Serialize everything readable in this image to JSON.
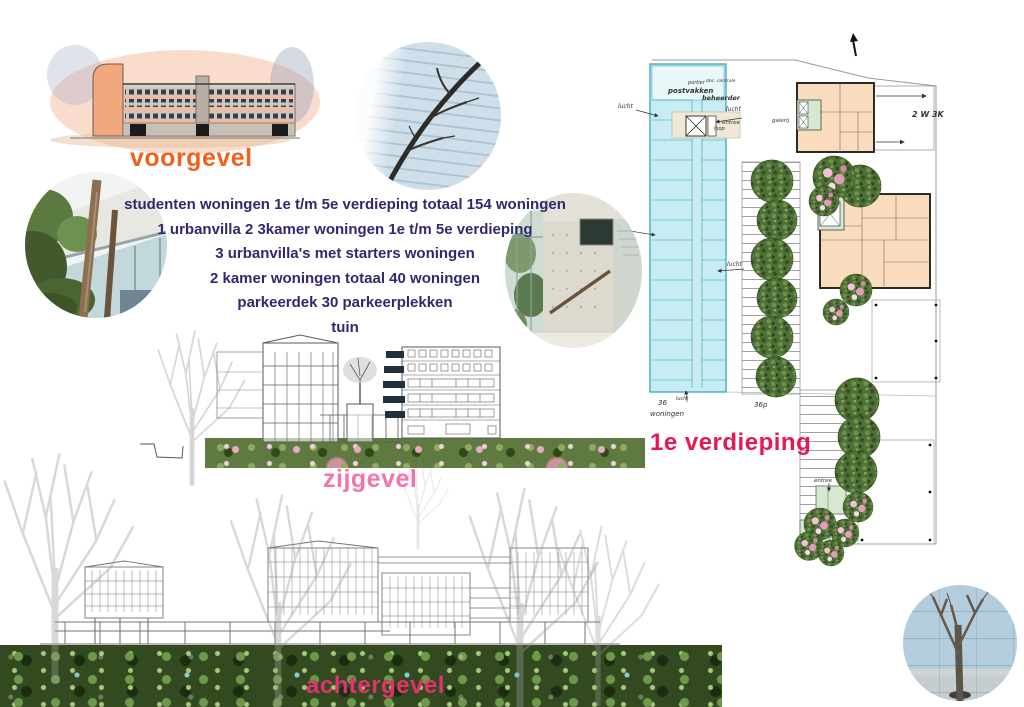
{
  "labels": {
    "voorgevel": "voorgevel",
    "zijgevel": "zijgevel",
    "achtergevel": "achtergevel",
    "floor": "1e verdieping"
  },
  "program": {
    "lines": [
      "studenten woningen 1e t/m 5e verdieping totaal 154 woningen",
      "1 urbanvilla 2 3kamer woningen 1e t/m 5e verdieping",
      "3 urbanvilla's met starters woningen",
      "2 kamer woningen totaal 40 woningen",
      "parkeerdek 30 parkeerplekken",
      "tuin"
    ]
  },
  "plan": {
    "portier": "portier",
    "postvakken": "postvakken",
    "centrale": "doc. centrale",
    "beheerder": "beheerder",
    "loop": "loop",
    "lucht": "lucht",
    "entree": "entree",
    "galerij": "galerij",
    "units_number": "36",
    "units_word": "woningen",
    "parking": "36p",
    "unit_mix": "2 W 3K"
  },
  "colors": {
    "voorgevel_label": "#f0611c",
    "zijgevel_label": "#f473ac",
    "achtergevel_label": "#e2326d",
    "floor_label": "#e5194f",
    "program_text": "#2d2a6e",
    "student_block_fill": "#c7edf2",
    "urbanvilla_fill": "#f8dcbd",
    "entry_core_fill": "#d6e9d0"
  }
}
